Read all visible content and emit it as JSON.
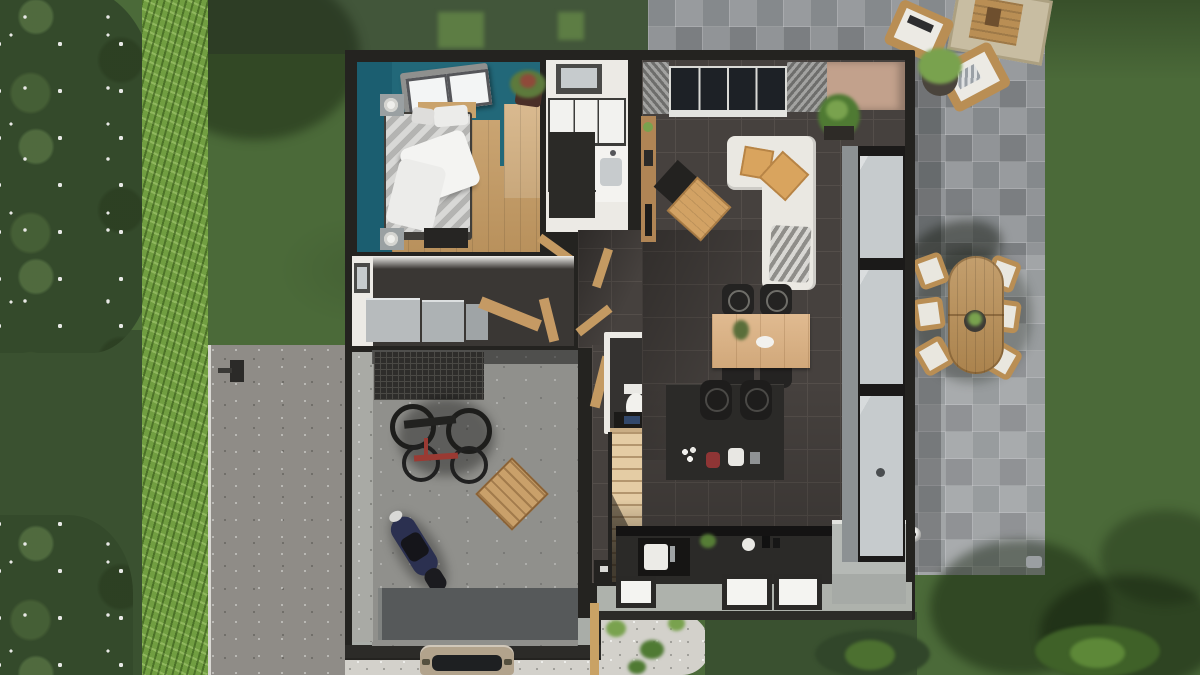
{
  "meta": {
    "title": "Top-down 3D architectural render of a single-storey house with garden, driveway and stone patio",
    "canvas": {
      "width": 1200,
      "height": 675
    }
  },
  "scene": {
    "rooms": [
      "bedroom",
      "bathroom",
      "wc",
      "hallway",
      "utility-room",
      "garage",
      "staircase",
      "open-plan-living-dining-kitchen"
    ],
    "exterior_features": [
      "flowering-trees",
      "hedge",
      "lawn",
      "gravel-driveway",
      "stone-patio",
      "outdoor-dining-set",
      "outdoor-lounge-chairs",
      "gravel-garden-bed",
      "parked-car",
      "soccer-ball"
    ],
    "counts": {
      "patio_dining_chairs": 6,
      "indoor_dining_chairs": 4,
      "bar_stools": 2,
      "bicycles": 2,
      "motorcycles": 1,
      "bedroom_skylights": 2,
      "living_roof_windows": 1
    }
  },
  "colors": {
    "lawn": "#4b6a39",
    "lawnDark": "#3a5130",
    "lawnTop": "#42563a",
    "lawnLight": "#5d7d44",
    "canopy": "#344a2b",
    "blossom": "#e8e9e6",
    "hedge": "#719e41",
    "driveway": "#8f8c87",
    "curb": "#d9d8d3",
    "paving": "#8c9093",
    "gravel": "#d3d1cb",
    "wallDark": "#242320",
    "footer": "#aeb2ac",
    "teal": "#226879",
    "tealDark": "#1b5e70",
    "wood": "#c49a62",
    "woodLight": "#d5b283",
    "stairs": "#e4cca4",
    "tile": "#46413e",
    "tileLine": "#544e4a",
    "white": "#eceae5",
    "glass": "#c6cbcd",
    "sofa": "#eae8e2",
    "cushion": "#d9a45e",
    "concrete": "#90908c",
    "apron": "#56595a",
    "counter": "#2b2a28",
    "cabinet": "#b5b9b5",
    "appliance": "#b7bbbd",
    "beige": "#c2a18c",
    "skyGlass": "#1d2126",
    "plant": "#4f7a33",
    "plantLight": "#79a24e",
    "planter": "#3d3a35",
    "moto": "#2b3050",
    "accentRed": "#9a3a33",
    "teak": "#b98e54",
    "car": "#b2a38c",
    "ball": "#f2f2f0"
  }
}
